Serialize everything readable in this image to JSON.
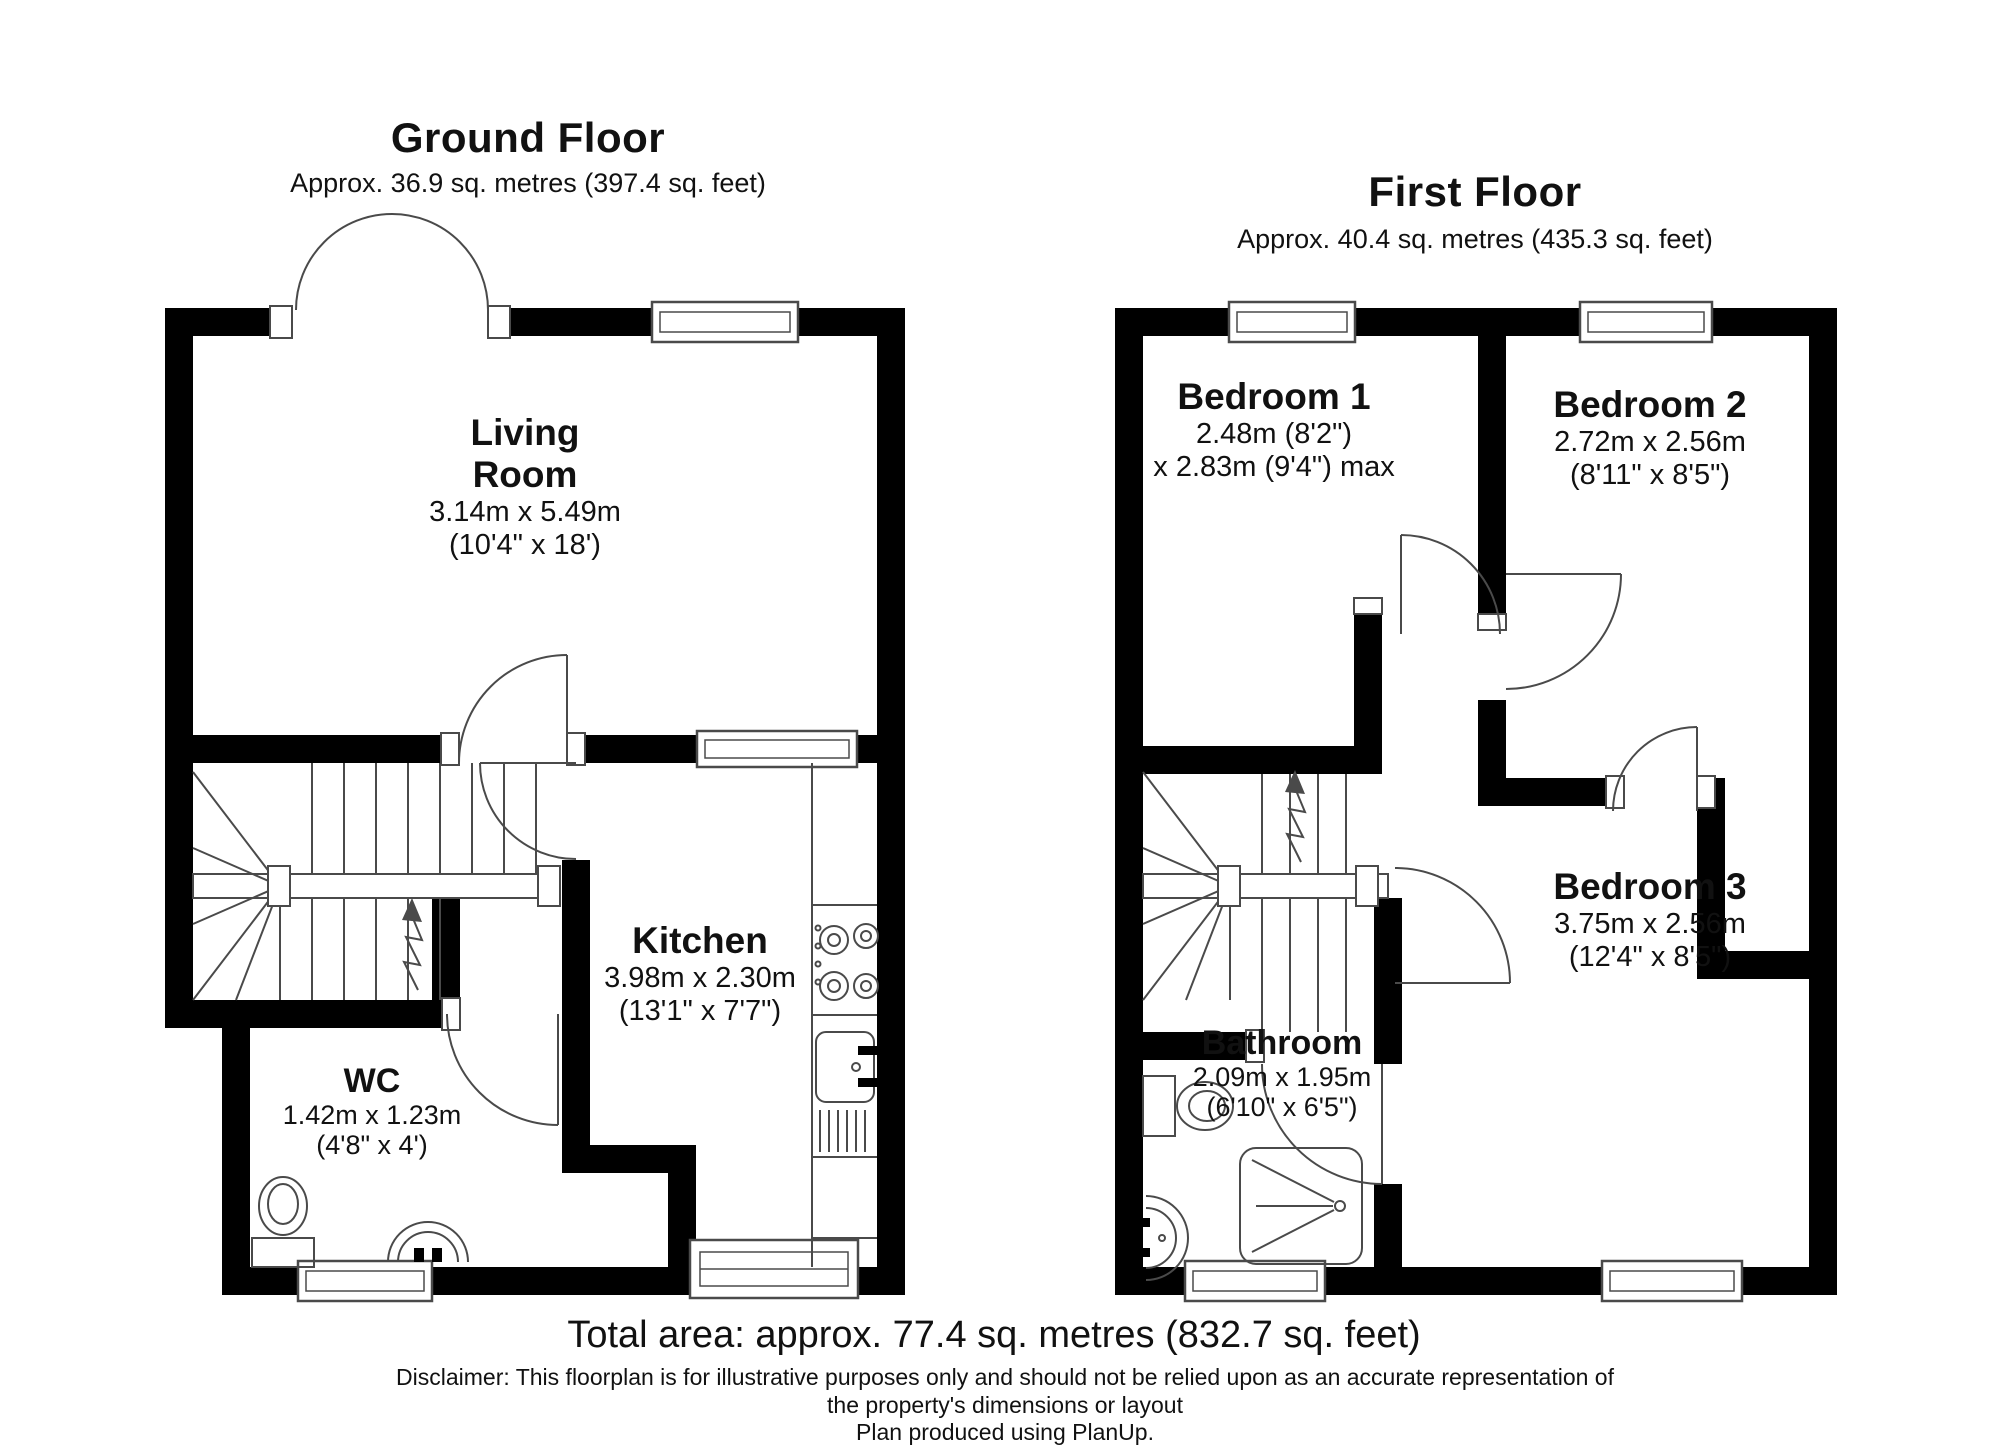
{
  "ground_floor": {
    "title": "Ground Floor",
    "subtitle": "Approx. 36.9 sq. metres (397.4 sq. feet)",
    "rooms": {
      "living": {
        "name_line1": "Living",
        "name_line2": "Room",
        "dims_m": "3.14m x 5.49m",
        "dims_ft": "(10'4\" x 18')"
      },
      "kitchen": {
        "name": "Kitchen",
        "dims_m": "3.98m x 2.30m",
        "dims_ft": "(13'1\" x 7'7\")"
      },
      "wc": {
        "name": "WC",
        "dims_m": "1.42m x 1.23m",
        "dims_ft": "(4'8\" x 4')"
      }
    }
  },
  "first_floor": {
    "title": "First Floor",
    "subtitle": "Approx. 40.4 sq. metres (435.3 sq. feet)",
    "rooms": {
      "bedroom1": {
        "name": "Bedroom 1",
        "dims_m": "2.48m (8'2\")",
        "dims_ft": "x 2.83m (9'4\") max"
      },
      "bedroom2": {
        "name": "Bedroom 2",
        "dims_m": "2.72m x 2.56m",
        "dims_ft": "(8'11\" x 8'5\")"
      },
      "bedroom3": {
        "name": "Bedroom 3",
        "dims_m": "3.75m x 2.56m",
        "dims_ft": "(12'4\" x 8'5\")"
      },
      "bathroom": {
        "name": "Bathroom",
        "dims_m": "2.09m x 1.95m",
        "dims_ft": "(6'10\" x 6'5\")"
      }
    }
  },
  "footer": {
    "total_area": "Total area: approx. 77.4 sq. metres (832.7 sq. feet)",
    "disclaimer_line1": "Disclaimer: This floorplan is for illustrative purposes only and should not be relied upon as an accurate representation of",
    "disclaimer_line2": "the property's dimensions or layout",
    "disclaimer_line3": "Plan produced using PlanUp."
  },
  "colors": {
    "wall": "#000000",
    "line": "#4a4a4a",
    "background": "#ffffff"
  }
}
